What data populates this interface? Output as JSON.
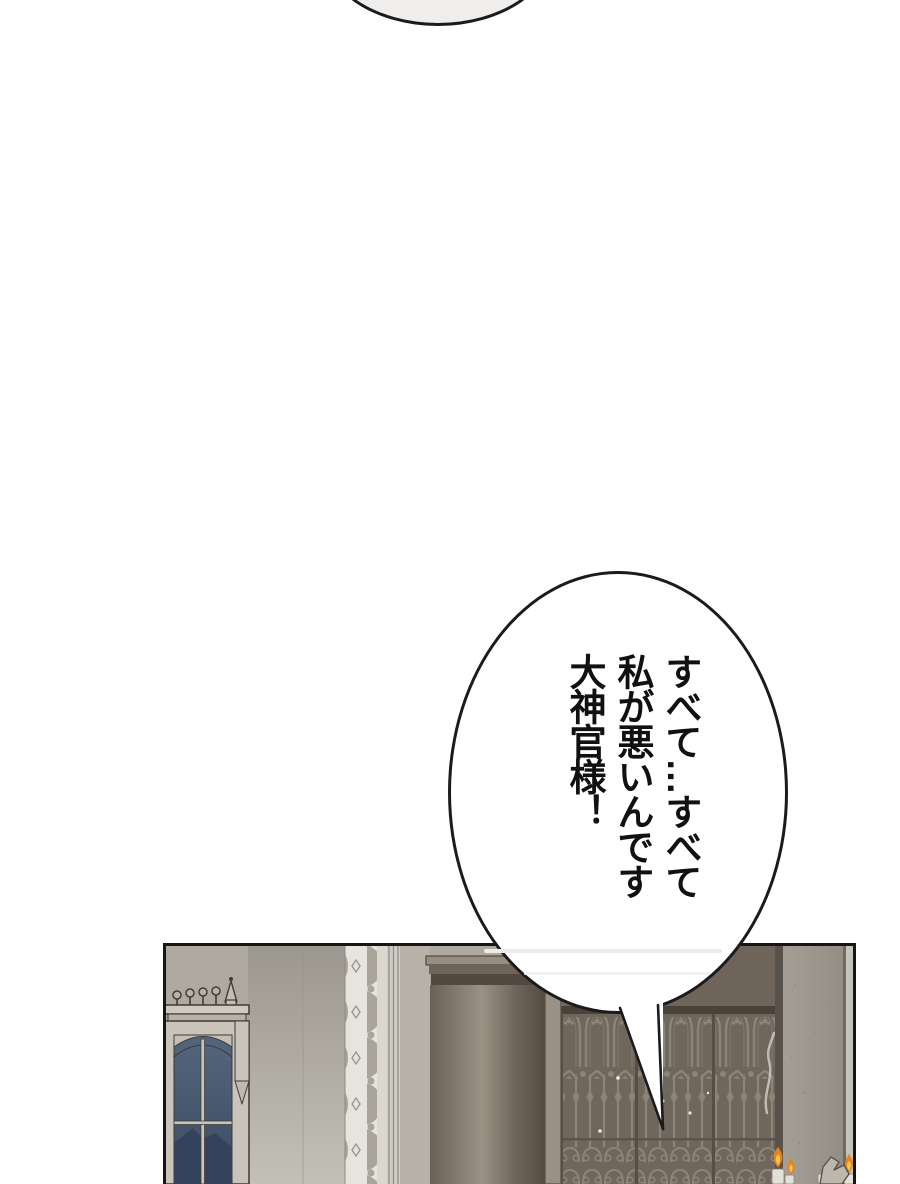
{
  "page": {
    "width": 900,
    "height": 1184,
    "background": "#ffffff",
    "kind": "webtoon-page"
  },
  "previous_panel_bubble": {
    "fill": "#efeeec",
    "stroke": "#1b1b1b"
  },
  "speech_bubble": {
    "fill": "#ffffff",
    "stroke": "#1b1b1b",
    "writing": "vertical-rl",
    "lines": [
      "すべて…すべて",
      "私が悪いんです",
      "大神官様！"
    ]
  },
  "panel": {
    "border_color": "#161616",
    "scene": "gothic-hall-interior",
    "colors": {
      "wall": "#aeaaa1",
      "wall_light": "#b6b2a9",
      "window_frame": "#c9c3b9",
      "window_glass_top": "#54657d",
      "window_glass_bottom": "#3b4b62",
      "trim_light": "#e6e4dc",
      "pillar_dark": "#6a6056",
      "cornice_shadow": "#52483f",
      "doorway": "#6e6459",
      "gate_bg": "#6f665c",
      "gate_iron": "#8d8478",
      "stone_pillar": "#a39f96",
      "stone_pillar_light": "#c6c3ba",
      "flame_outer": "#e8821c",
      "flame_inner": "#f8c84e",
      "candle": "#e3e0d7"
    }
  }
}
